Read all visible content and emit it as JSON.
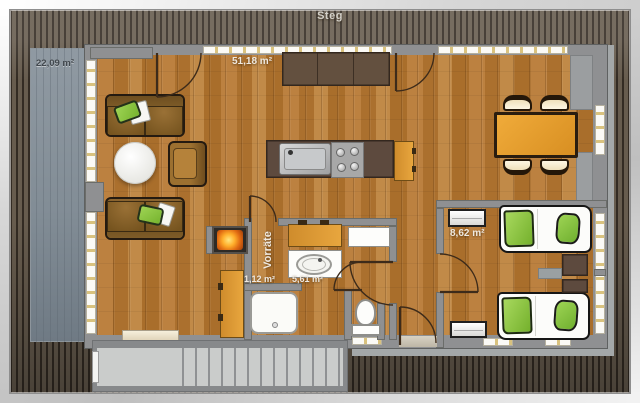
{
  "plan": {
    "walkway_label": "Steg",
    "rooms": [
      {
        "id": "terrace",
        "area_label": "22,09 m²"
      },
      {
        "id": "living-kitchen",
        "area_label": "51,18 m²"
      },
      {
        "id": "bedroom",
        "area_label": "8,62 m²"
      },
      {
        "id": "pantry",
        "area_label": "1,12 m²",
        "name_label": "Vorräte"
      },
      {
        "id": "bathroom",
        "area_label": "5,61 m²"
      }
    ],
    "colors": {
      "decking": "#4a4136",
      "terrace": "#b9c0c6",
      "wall_gray": "#8f9092",
      "wood_floor": "#b5793a",
      "furniture_orange": "#e09a33",
      "furniture_darkwood": "#5d4a3e",
      "bedding_green": "#8cc63f",
      "window_white": "#fbfaf6",
      "stairs_gray": "#cacccb",
      "fire_glow": "#ff9b1f"
    }
  }
}
